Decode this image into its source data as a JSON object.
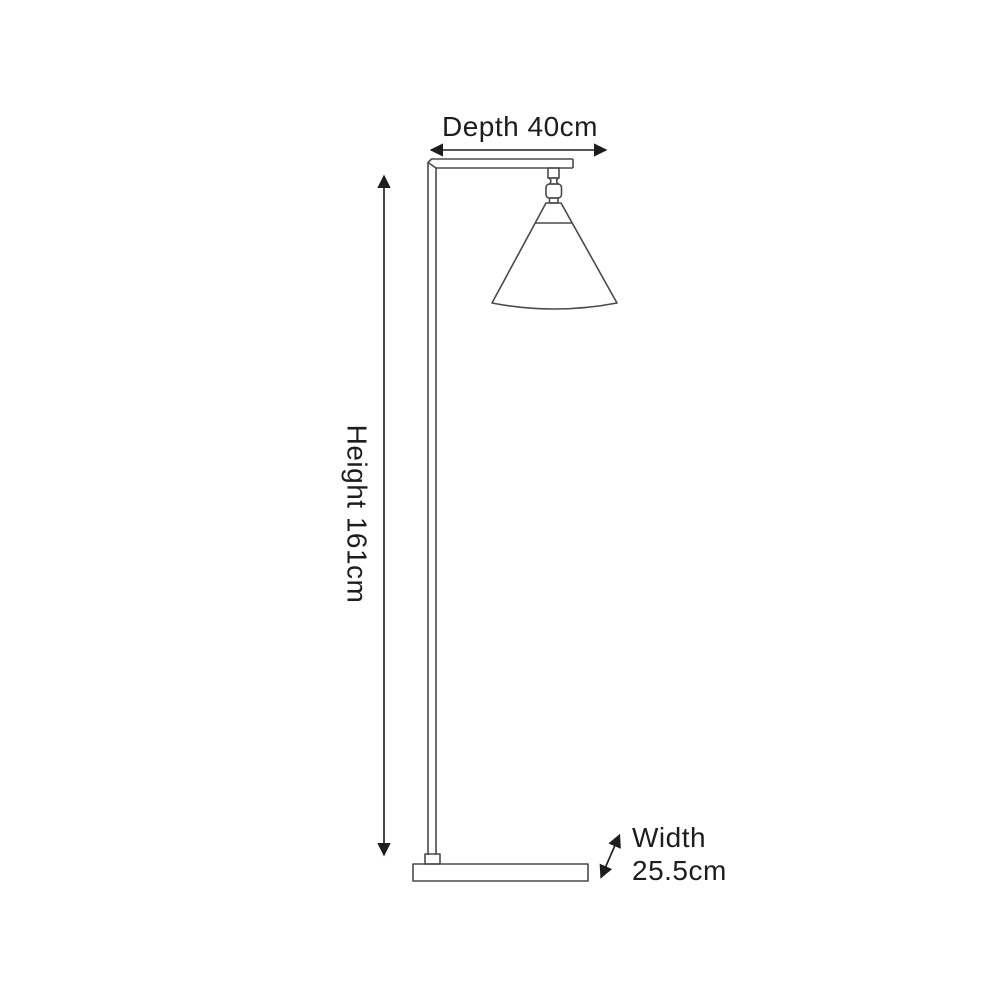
{
  "diagram": {
    "subject": "floor-lamp-dimension-drawing",
    "background": "#ffffff",
    "line_color": "#4a4a4a",
    "annotation_color": "#1d1d1d",
    "labels": {
      "depth": "Depth 40cm",
      "height": "Height 161cm",
      "width_name": "Width",
      "width_value": "25.5cm"
    },
    "dimensions_cm": {
      "depth": 40,
      "height": 161,
      "width": 25.5
    }
  }
}
